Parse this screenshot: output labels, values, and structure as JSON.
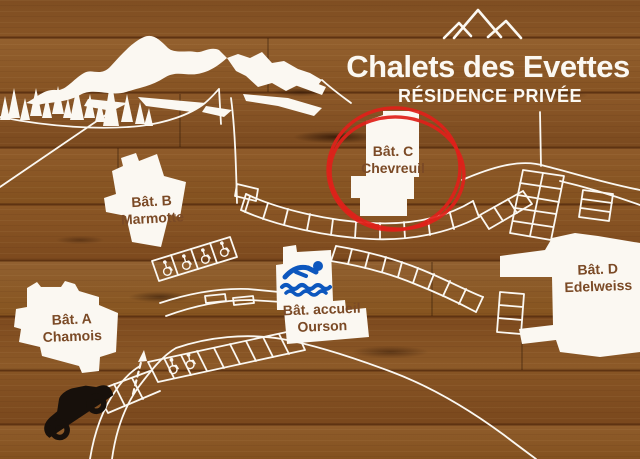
{
  "sign": {
    "title": "Chalets des Evettes",
    "subtitle": "RÉSIDENCE PRIVÉE",
    "highlighted_building": "Bât. C"
  },
  "buildings": [
    {
      "code": "Bât. A",
      "name": "Chamois"
    },
    {
      "code": "Bât. B",
      "name": "Marmotte"
    },
    {
      "code": "Bât. C",
      "name": "Chevreuil",
      "highlighted": true
    },
    {
      "code": "Bât. D",
      "name": "Edelweiss"
    },
    {
      "code": "Bât. accueil",
      "name": "Ourson",
      "amenity_icon": "swimmer-icon"
    }
  ],
  "icons": {
    "logo": "mountain-peaks-icon",
    "pool": "swimmer-icon",
    "accessible_parking": "wheelchair-icon",
    "car": "car-icon",
    "entrance": "dashed-arrow-icon"
  },
  "colors": {
    "wood": "#8a5626",
    "white": "#fbf8f2",
    "label_text": "#7b4a26",
    "highlight_red": "#e0201a",
    "pool_blue": "#0d57be",
    "car_black": "#17100b"
  }
}
